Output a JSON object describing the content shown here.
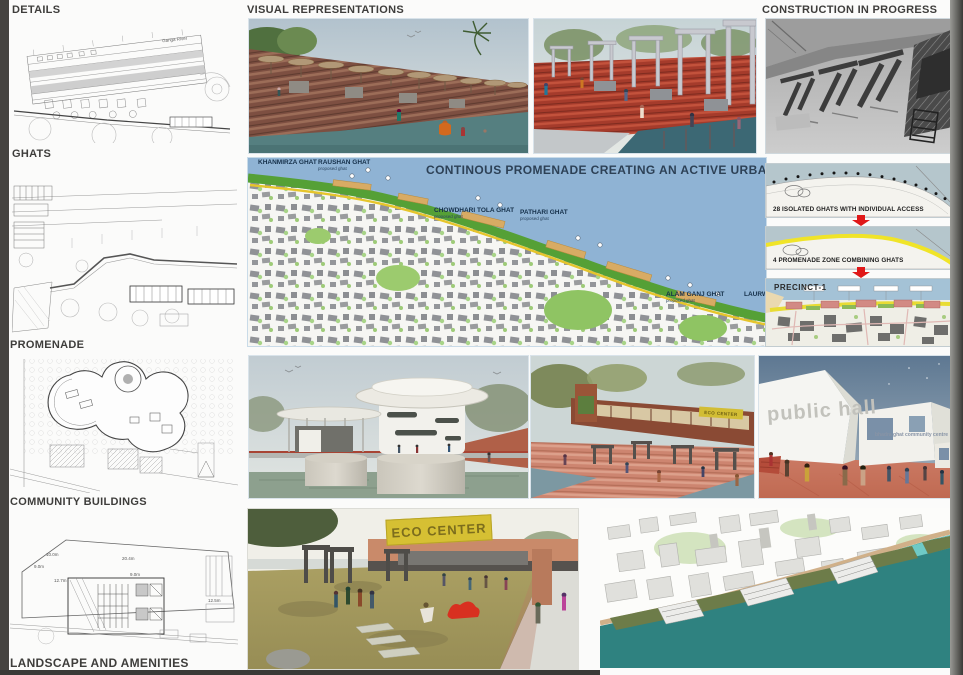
{
  "headings": {
    "details": "DETAILS",
    "ghats": "GHATS",
    "promenade": "PROMENADE",
    "community_buildings": "COMMUNITY BUILDINGS",
    "landscape": "LANDSCAPE AND AMENITIES",
    "visual_representations": "VISUAL REPRESENTATIONS",
    "construction_in_progress": "CONSTRUCTION IN PROGRESS"
  },
  "map": {
    "title": "CONTINOUS PROMENADE CREATING AN ACTIVE URBAN EDGE",
    "ghats": [
      {
        "name": "KHANMIRZA GHAT",
        "sub": ""
      },
      {
        "name": "RAUSHAN GHAT",
        "sub": "proposed ghat"
      },
      {
        "name": "CHOWDHARI TOLA GHAT",
        "sub": "proposed ghat"
      },
      {
        "name": "PATHARI GHAT",
        "sub": "proposed ghat"
      },
      {
        "name": "ALAM GANJ GHAT",
        "sub": "proposed ghat"
      },
      {
        "name": "LAURWA GHAT",
        "sub": ""
      }
    ]
  },
  "strategy_diagrams": {
    "isolated": "28 ISOLATED GHATS WITH INDIVIDUAL ACCESS",
    "promenade_zones": "4 PROMENADE ZONE COMBINING GHATS",
    "precinct": "PRECINCT-1"
  },
  "renders": {
    "eco_center_sign": "ECO CENTER",
    "ghat_center_sign": "ECO CENTER",
    "public_hall_text": "public hall",
    "community_centre_text": "bhadra ghat community centre"
  },
  "details_drawing": {
    "river_label": "Ganga River"
  },
  "community_drawing": {
    "dims": [
      "10.0m",
      "9.0m",
      "12.7m",
      "20.4m",
      "9.0m",
      "12.5m"
    ]
  },
  "colors": {
    "accent_red": "#e01818",
    "promenade_yellow": "#e7c52e",
    "shore_green": "#55a036",
    "river_teal": "#2f8280",
    "map_water": "#8fb3d4"
  }
}
